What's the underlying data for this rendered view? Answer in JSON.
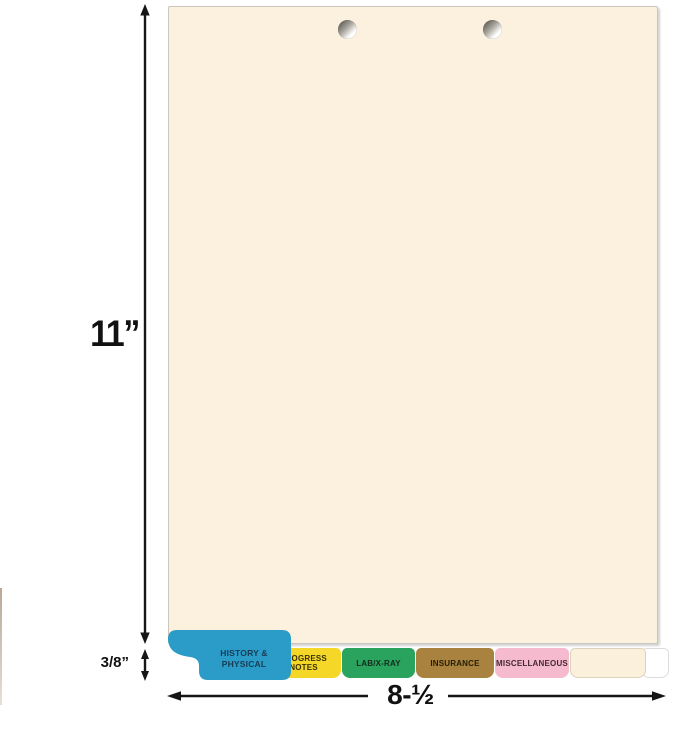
{
  "page": {
    "background": "#ffffff"
  },
  "sheet": {
    "description": "manila chart divider sheet with two punched holes",
    "color": "#fcf1de",
    "hole_count": 2
  },
  "dimensions": {
    "height_label": "11”",
    "width_label": "8-½",
    "tab_height_label": "3/8”",
    "arrow_color": "#161616"
  },
  "tabs": [
    {
      "label_line1": "HISTORY &",
      "label_line2": "PHYSICAL",
      "color": "#2b9cc8",
      "text_color": "#173c54"
    },
    {
      "label": "PROGRESS NOTES",
      "color": "#f5d827",
      "text_color": "#3a3005"
    },
    {
      "label": "LAB/X-RAY",
      "color": "#2aa35e",
      "text_color": "#122b1b"
    },
    {
      "label": "INSURANCE",
      "color": "#a8823e",
      "text_color": "#261d07"
    },
    {
      "label": "MISCELLANEOUS",
      "color": "#f5bacd",
      "text_color": "#432832"
    },
    {
      "label": "",
      "color": "#fbf0dc",
      "text_color": "#000000"
    },
    {
      "label": "",
      "color": "#ffffff",
      "text_color": "#000000"
    }
  ]
}
